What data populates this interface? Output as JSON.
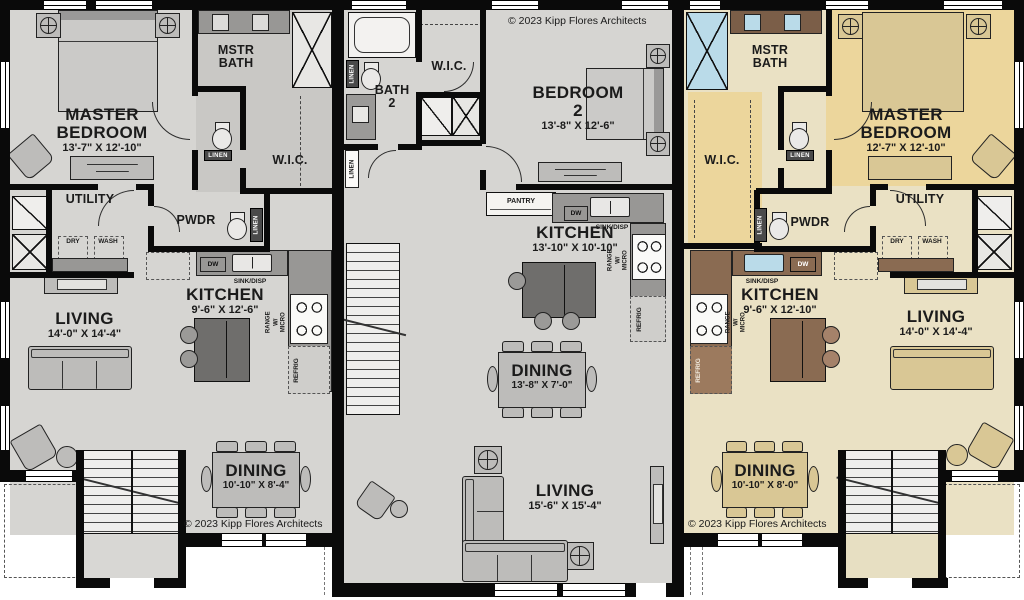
{
  "copyright": "© 2023 Kipp Flores Architects",
  "colors": {
    "wall": "#0a0a0a",
    "text": "#1b1b1b",
    "floor_gray": "#d6d5d2",
    "floor_gray_dark": "#c9c8c5",
    "furn_gray": "#bdbcba",
    "furn_gray_dark": "#9b9a98",
    "counter_gray": "#989795",
    "island_gray": "#6f6e6c",
    "floor_cream": "#eae1c4",
    "floor_yellow": "#ecd69c",
    "counter_brown": "#8a6b52",
    "vanity_brown": "#7b5e48",
    "island_brown": "#8a6b52",
    "furn_tan": "#d9c795",
    "window_blue": "#badbe9",
    "tag_dark": "#4a4a4a"
  },
  "units": {
    "left": {
      "master_bedroom": {
        "label": "MASTER BEDROOM",
        "dims": "13'-7\" X 12'-10\""
      },
      "mstr_bath": {
        "label": "MSTR BATH"
      },
      "wic": {
        "label": "W.I.C."
      },
      "utility": {
        "label": "UTILITY"
      },
      "pwdr": {
        "label": "PWDR"
      },
      "laundry": {
        "dry": "DRY",
        "wash": "WASH"
      },
      "linen": "LINEN",
      "kitchen": {
        "label": "KITCHEN",
        "dims": "9'-6\" X 12'-6\"",
        "dw": "DW",
        "sink": "SINK/DISP",
        "range": "RANGE W/ MICRO",
        "refrig": "REFRIG"
      },
      "living": {
        "label": "LIVING",
        "dims": "14'-0\" X 14'-4\""
      },
      "dining": {
        "label": "DINING",
        "dims": "10'-10\" X 8'-4\""
      },
      "copyright": "© 2023 Kipp Flores Architects"
    },
    "middle": {
      "bath2": {
        "label": "BATH 2"
      },
      "wic": {
        "label": "W.I.C."
      },
      "bedroom2": {
        "label": "BEDROOM 2",
        "dims": "13'-8\" X 12'-6\""
      },
      "linen": "LINEN",
      "pantry": "PANTRY",
      "kitchen": {
        "label": "KITCHEN",
        "dims": "13'-10\" X 10'-10\"",
        "dw": "DW",
        "sink": "SINK/DISP",
        "range": "RANGE W/ MICRO",
        "refrig": "REFRIG"
      },
      "dining": {
        "label": "DINING",
        "dims": "13'-8\" X 7'-0\""
      },
      "living": {
        "label": "LIVING",
        "dims": "15'-6\" X 15'-4\""
      },
      "copyright": "© 2023 Kipp Flores Architects"
    },
    "right": {
      "mstr_bath": {
        "label": "MSTR BATH"
      },
      "master_bedroom": {
        "label": "MASTER BEDROOM",
        "dims": "12'-7\" X 12'-10\""
      },
      "wic": {
        "label": "W.I.C."
      },
      "pwdr": {
        "label": "PWDR"
      },
      "utility": {
        "label": "UTILITY"
      },
      "laundry": {
        "dry": "DRY",
        "wash": "WASH"
      },
      "linen": "LINEN",
      "kitchen": {
        "label": "KITCHEN",
        "dims": "9'-6\" X 12'-10\"",
        "dw": "DW",
        "sink": "SINK/DISP",
        "range": "RANGE W/ MICRO",
        "refrig": "REFRIG"
      },
      "living": {
        "label": "LIVING",
        "dims": "14'-0\" X 14'-4\""
      },
      "dining": {
        "label": "DINING",
        "dims": "10'-10\" X 8'-0\""
      },
      "copyright": "© 2023 Kipp Flores Architects"
    }
  }
}
